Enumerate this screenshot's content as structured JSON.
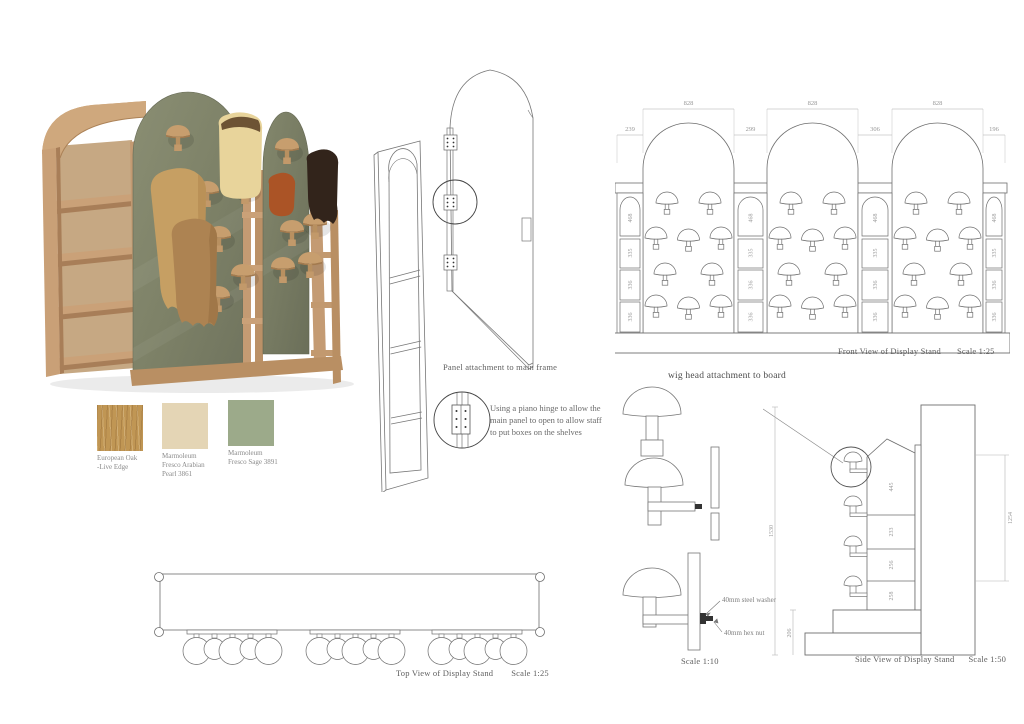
{
  "materials": [
    {
      "name": "european-oak",
      "color": "#c09654",
      "lines": [
        "European Oak",
        "-Live Edge"
      ]
    },
    {
      "name": "marmoleum-fresco-arabian-pearl",
      "color": "#e4d5b5",
      "lines": [
        "Marmoleum",
        "Fresco Arabian",
        "Pearl 3861"
      ]
    },
    {
      "name": "marmoleum-fresco-sage",
      "color": "#9caa8a",
      "lines": [
        "Marmoleum",
        "Fresco Sage 3891"
      ]
    }
  ],
  "panel_attachment": {
    "caption": "Panel attachment to main frame",
    "hinge_note": "Using a piano hinge to allow the main panel to open to allow staff to put boxes on the shelves"
  },
  "front_view": {
    "caption": "Front View of Display Stand",
    "scale": "Scale 1:25",
    "arch_width": "828",
    "gaps": [
      "239",
      "299",
      "306",
      "196"
    ],
    "column_dims": [
      "468",
      "335",
      "336",
      "336"
    ]
  },
  "top_view": {
    "caption": "Top View of Display Stand",
    "scale": "Scale 1:25"
  },
  "side_view": {
    "caption": "Side View of Display Stand",
    "scale": "Scale 1:50",
    "total_height": "1530",
    "base_height": "206",
    "right_height": "1254",
    "shelf_dims": [
      "445",
      "233",
      "256",
      "258"
    ]
  },
  "wig_attachment": {
    "title": "wig head attachment to board",
    "scale": "Scale 1:10",
    "washer_label": "40mm steel washer",
    "nut_label": "40mm hex nut"
  },
  "colors": {
    "wood": "#c69d75",
    "sage_panel": "#7e8168",
    "line": "#6e6e6e",
    "dim_text": "#9a9a9a"
  }
}
